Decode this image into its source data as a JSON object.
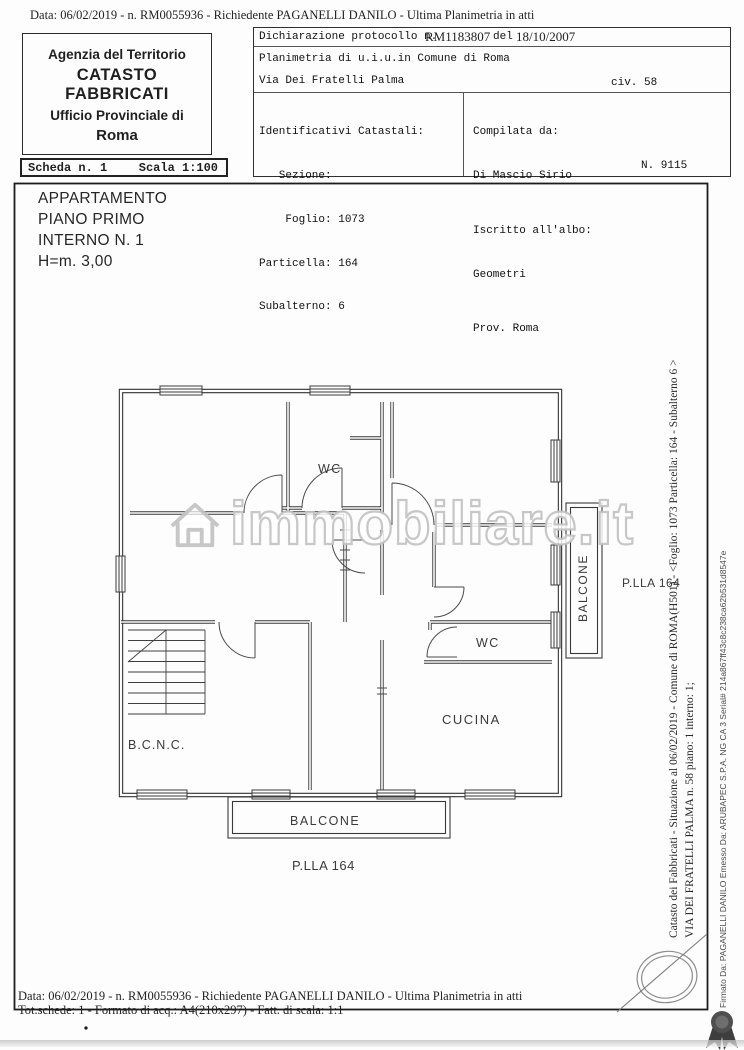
{
  "scan": {
    "header_line": "Data: 06/02/2019 -  n. RM0055936 - Richiedente PAGANELLI DANILO - Ultima Planimetria in atti",
    "footer_line1": "Data: 06/02/2019 -  n. RM0055936 - Richiedente PAGANELLI DANILO - Ultima Planimetria in atti",
    "footer_line2": "Tot.schede: 1 - Formato di acq.: A4(210x297) - Fatt. di scala: 1:1"
  },
  "agency": {
    "line1": "Agenzia del Territorio",
    "line2": "CATASTO FABBRICATI",
    "line3": "Ufficio Provinciale di",
    "line4": "Roma"
  },
  "scheda": {
    "label": "Scheda n. 1",
    "scala": "Scala 1:100"
  },
  "declaration": {
    "protocol_label": "Dichiarazione protocollo n.",
    "protocol_value": "RM1183807",
    "del_label": "del",
    "protocol_date": "18/10/2007",
    "line2": "Planimetria di u.i.u.in Comune di Roma",
    "street": "Via Dei Fratelli Palma",
    "civ": "civ. 58"
  },
  "identificativi": {
    "lines": [
      "Identificativi Catastali:",
      "   Sezione:",
      "    Foglio: 1073",
      "Particella: 164",
      "Subalterno: 6"
    ]
  },
  "compilata": {
    "title": "Compilata da:",
    "name": "Di Mascio Sirio",
    "albo_label": "Iscritto all'albo:",
    "albo_value": "Geometri",
    "prov": "Prov. Roma",
    "number": "N. 9115"
  },
  "apartment": {
    "lines": [
      "APPARTAMENTO",
      "PIANO PRIMO",
      "INTERNO N. 1",
      "H=m. 3,00"
    ]
  },
  "plan": {
    "wc1": "WC",
    "wc2": "WC",
    "cucina": "CUCINA",
    "bcnc": "B.C.N.C.",
    "balcone_right": "BALCONE",
    "balcone_bottom": "BALCONE",
    "plla_right": "P.LLA 164",
    "plla_bottom": "P.LLA 164"
  },
  "watermark": {
    "text": "immobiliare.it"
  },
  "margin": {
    "catasto_line": "Catasto dei Fabbricati - Situazione al 06/02/2019 - Comune di ROMA(H501) - <Foglio: 1073 Particella: 164 - Subalterno 6 >",
    "via_line": "VIA DEI FRATELLI PALMA n. 58 piano: 1 interno: 1;",
    "firmato_line": "Firmato Da: PAGANELLI DANILO Emesso Da: ARUBAPEC S.P.A. NG CA 3 Serial# 214a867ff43c8c238ca62b531d8547e"
  },
  "colors": {
    "paper": "#fdfdfd",
    "ink": "#1f1f1f",
    "watermark_gray": "#c9c9c9",
    "rosette_gray": "#4f4f4f"
  }
}
